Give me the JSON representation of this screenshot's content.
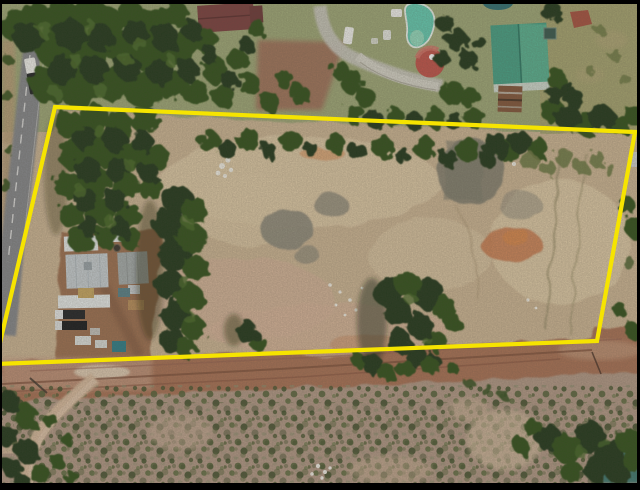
{
  "meta": {
    "content_type": "drone aerial photograph",
    "description": "Top-down aerial/drone photo of a rural erf: a cleared sandy plot outlined with a thick yellow surveyed-boundary polygon, farm sheds and vehicles on the west side, a neighbouring homestead with swimming pool, red round gazebo roof and green-roofed house to the north, a tar road on the west, a dirt road along the south boundary and scrubland in the foreground. Thin black letterbox frame around the photo."
  },
  "overlay": {
    "boundary": {
      "points": "55,107 635,132 597,341 -5,364",
      "color": "#F6E400",
      "width": 4.2,
      "label": "property-boundary"
    },
    "frame": {
      "color": "#000000",
      "top": 4,
      "bottom": 7,
      "left": 2,
      "right": 3
    }
  },
  "scene": {
    "features": [
      "pine-forest-north-west",
      "tar-road-west",
      "white-truck-on-road",
      "maroon-roof-building",
      "concrete-driveway",
      "parked-white-cars",
      "kidney-swimming-pool",
      "red-round-gazebo-roof",
      "green-roof-house",
      "rusted-shed",
      "small-pond-top-edge",
      "cleared-sandy-plot",
      "grey-rubble-patches",
      "orange-soil-patch",
      "white-debris-piles",
      "farm-sheds-compound",
      "parked-trucks",
      "large-trees-inside-plot",
      "dirt-road-south-boundary",
      "scrubland-foreground",
      "sandy-footpath",
      "tree-clump-bottom-right",
      "teal-pond-bottom-right-corner"
    ]
  },
  "palette": {
    "frame": "#000000",
    "boundary": "#F6E400",
    "sand": "#cdb695",
    "sandLight": "#decaa7",
    "sandPink": "#d5b49a",
    "grayPatch": "#8d897b",
    "rubbleGray": "#7f7d6e",
    "orange": "#c97a4e",
    "orangeBright": "#d8884f",
    "lawn": "#9fa878",
    "lawnOlive": "#a6a471",
    "treeDark": "#24391c",
    "tree": "#33511f",
    "treeLight": "#4a6c2b",
    "treeOlive": "#6f7a45",
    "treeShadow": "#18230f",
    "scrubBase": "#b29987",
    "roadTar": "#86888c",
    "roadDirt": "#a97257",
    "roadDirtLight": "#c79e85",
    "trackBrown": "#7c4e3b",
    "pathSand": "#d8bb9f",
    "pool": "#64cbb2",
    "poolLight": "#98ddc0",
    "roofGreen": "#47a085",
    "roofGreenLight": "#5fb795",
    "roofMaroon": "#7c4140",
    "gazeboRed": "#c1544b",
    "roofWhite": "#e7ebea",
    "roofGray": "#c7ced2",
    "roofDarkGray": "#a6adad",
    "rustShed": "#83573c",
    "pondTeal": "#2f6f74",
    "pondCorner": "#3d7a74",
    "truckDark": "#232528",
    "white": "#f2f2ef",
    "dirtYard": "#9c6e50",
    "driveDirt": "#a1705a",
    "driveConcrete": "#c9c7bd"
  }
}
